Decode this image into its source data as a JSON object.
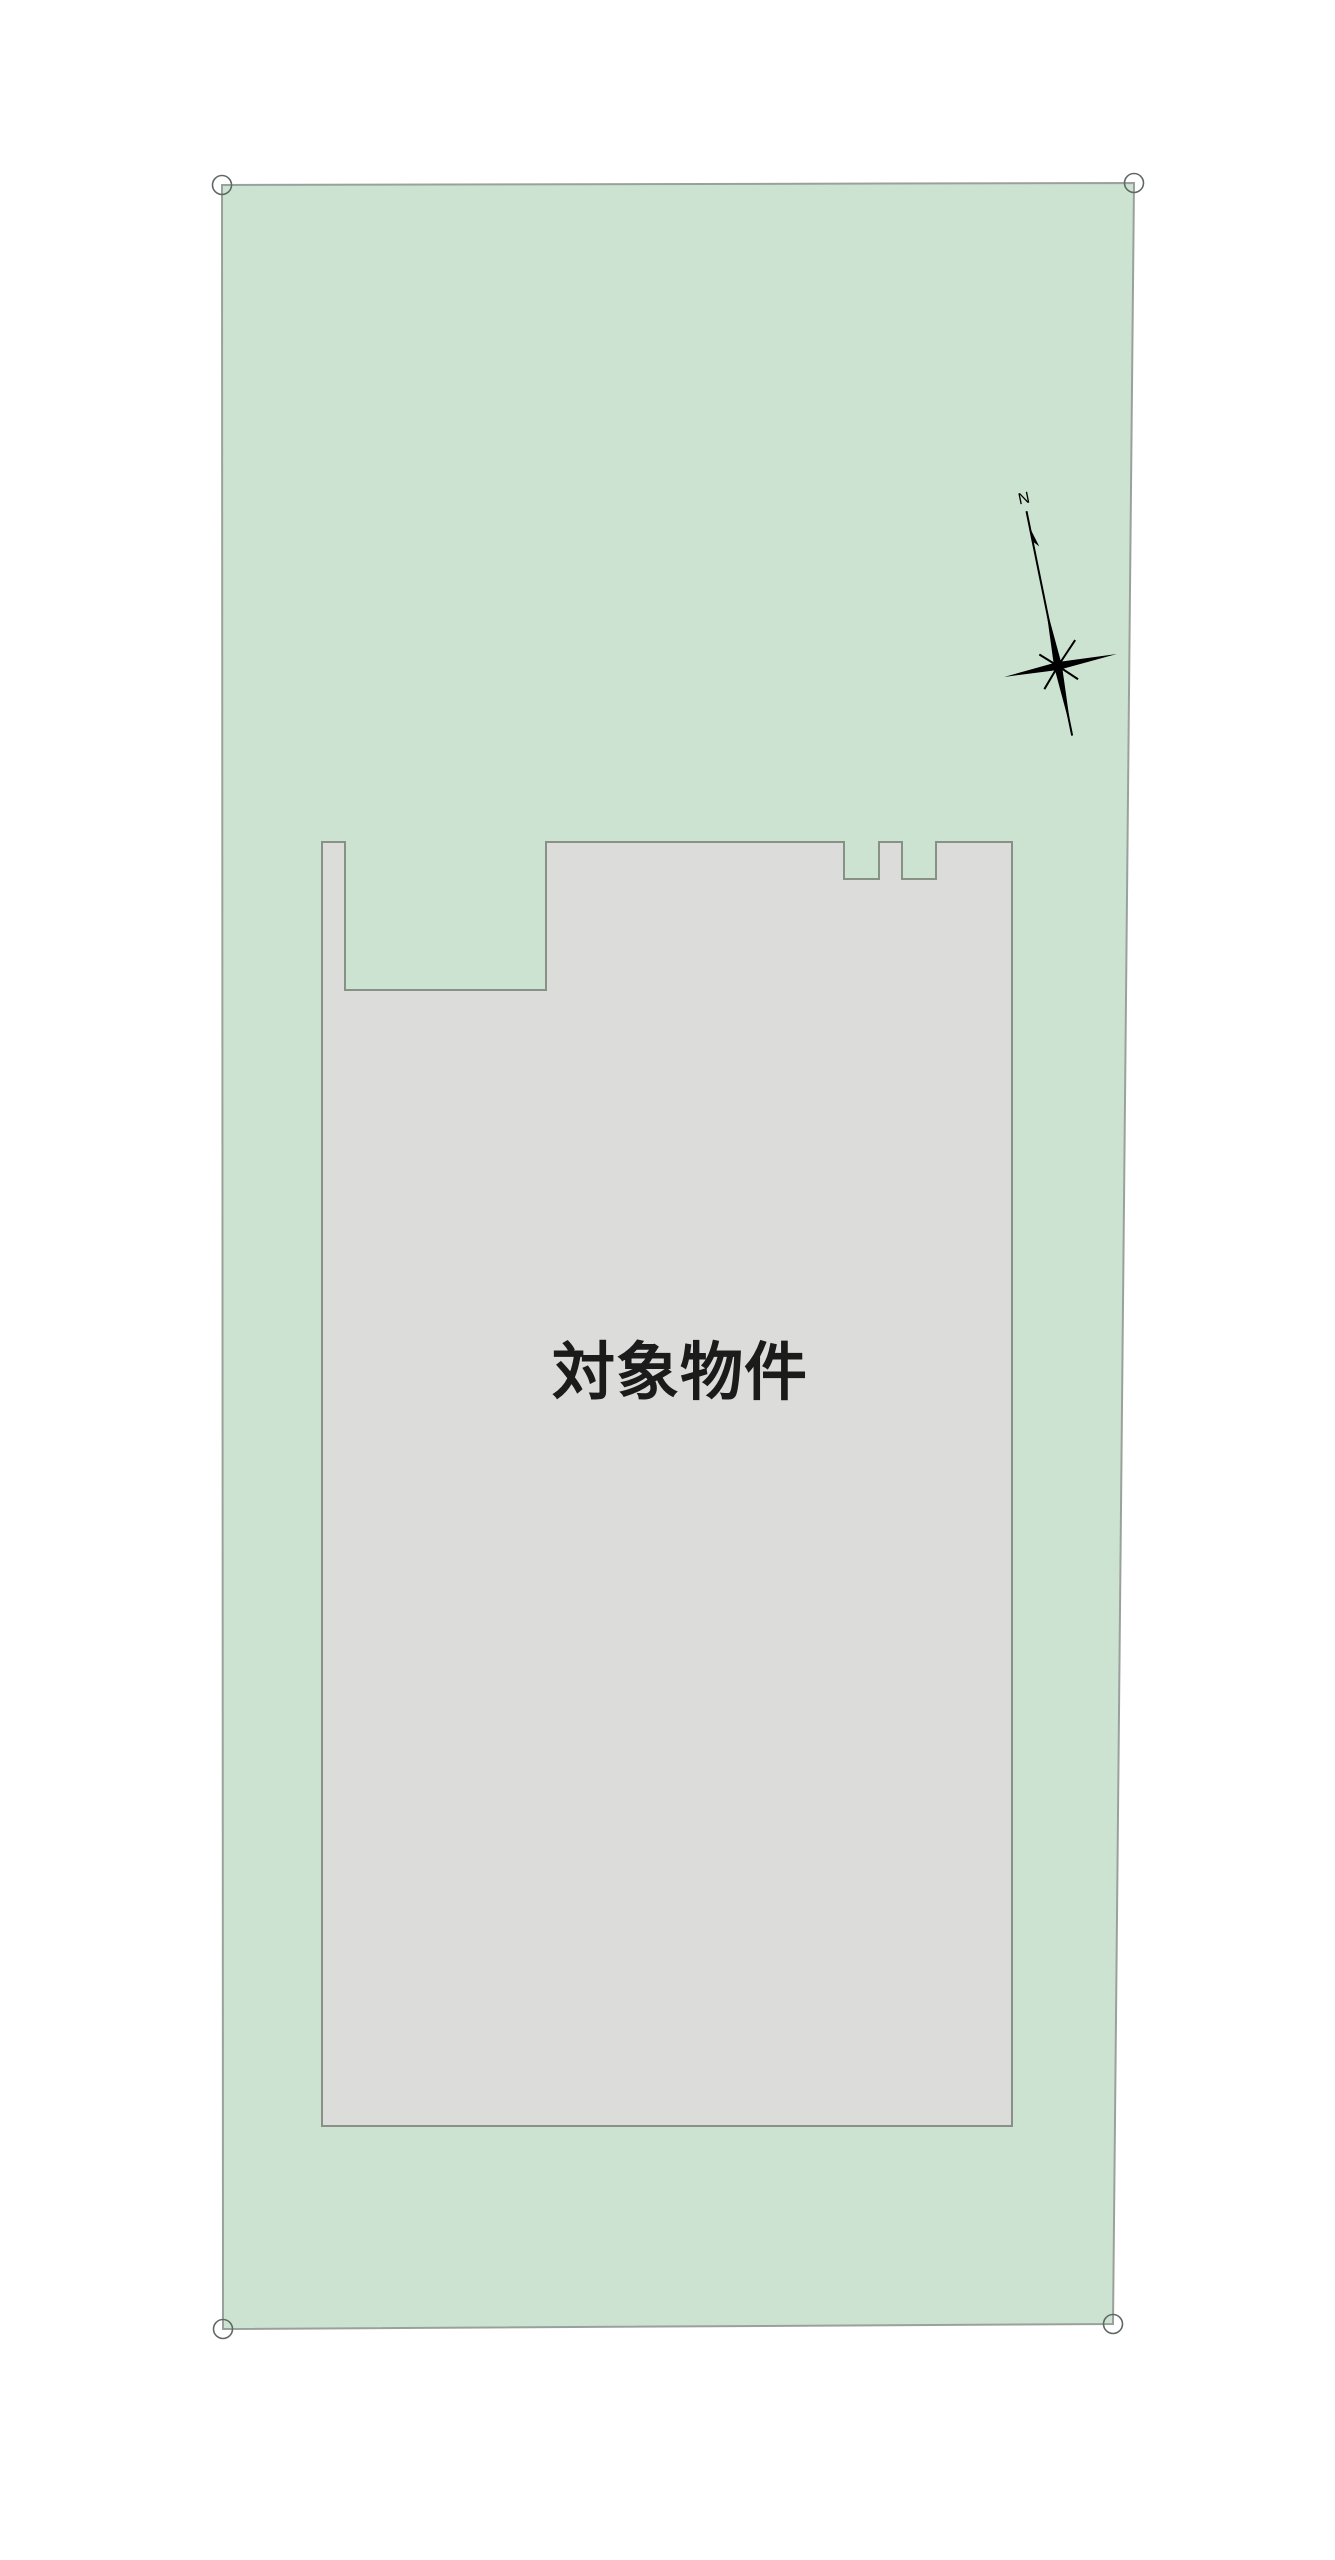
{
  "page": {
    "background": "#ffffff"
  },
  "site_plan": {
    "parcel": {
      "fill": "#cde3d1",
      "stroke": "#9aa19b"
    },
    "building": {
      "fill": "#dcdddb",
      "stroke": "#879185",
      "label": "対象物件",
      "label_color": "#1b1b1b"
    },
    "compass": {
      "north_label": "N",
      "color": "#000000"
    },
    "corner_markers": {
      "stroke": "#606866"
    }
  }
}
